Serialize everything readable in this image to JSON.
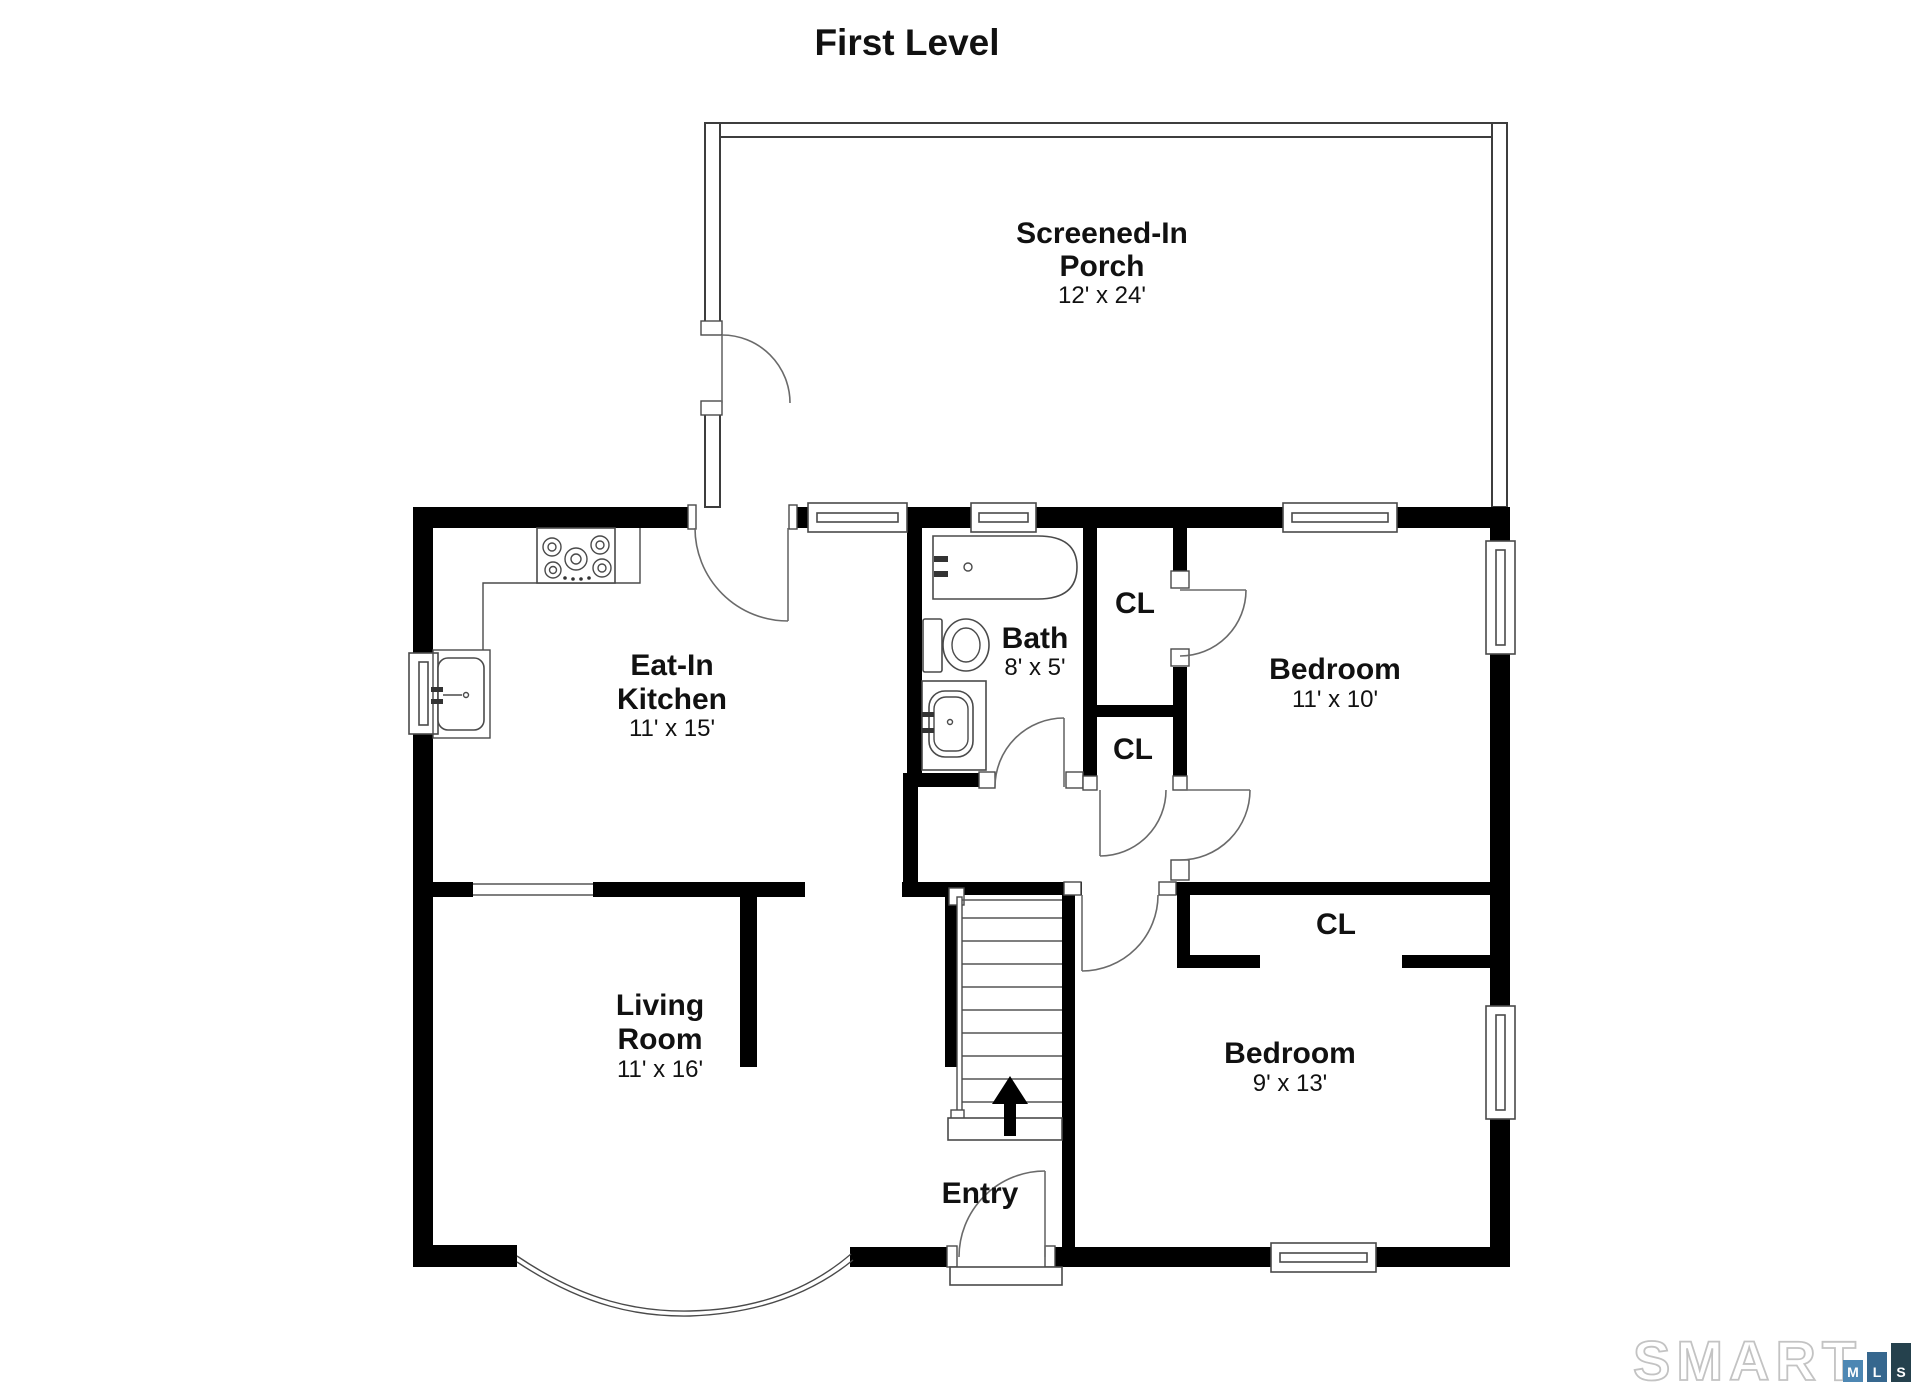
{
  "title": "First Level",
  "rooms": {
    "porch": {
      "line1": "Screened-In",
      "line2": "Porch",
      "dims": "12' x 24'"
    },
    "kitchen": {
      "line1": "Eat-In",
      "line2": "Kitchen",
      "dims": "11' x 15'"
    },
    "bath": {
      "name": "Bath",
      "dims": "8' x 5'"
    },
    "bedroom1": {
      "name": "Bedroom",
      "dims": "11' x 10'"
    },
    "bedroom2": {
      "name": "Bedroom",
      "dims": "9' x 13'"
    },
    "living": {
      "line1": "Living",
      "line2": "Room",
      "dims": "11' x 16'"
    },
    "entry": {
      "name": "Entry"
    },
    "closet1": {
      "name": "CL"
    },
    "closet2": {
      "name": "CL"
    },
    "closet3": {
      "name": "CL"
    }
  },
  "stairs": {
    "direction": "up"
  },
  "logo": {
    "word": "SMART",
    "boxes": [
      {
        "letter": "M",
        "color": "#4d87b3"
      },
      {
        "letter": "L",
        "color": "#36678e"
      },
      {
        "letter": "S",
        "color": "#25414d"
      }
    ]
  },
  "colors": {
    "wall": "#000000",
    "line": "#4a4a4a",
    "text": "#111111"
  }
}
